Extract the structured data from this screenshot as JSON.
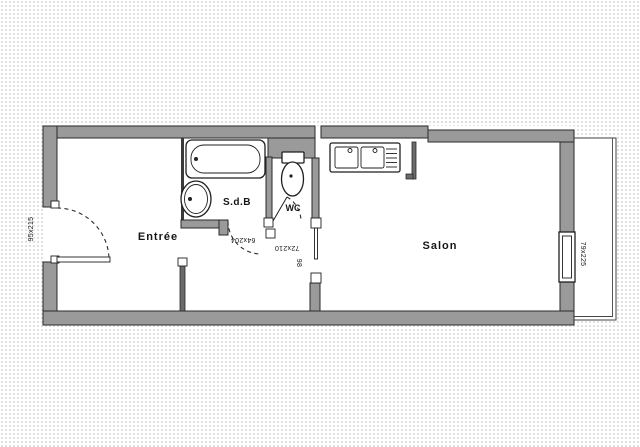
{
  "colors": {
    "paper": "#ffffff",
    "dot_grid": "#d7d7d7",
    "wall_fill": "#9a9a9a",
    "wall_dark": "#6b6b6b",
    "outline": "#2a2a2a"
  },
  "rooms": [
    {
      "name": "entree",
      "label": "Entrée"
    },
    {
      "name": "sdb",
      "label": "S.d.B"
    },
    {
      "name": "wc",
      "label": "WC"
    },
    {
      "name": "salon",
      "label": "Salon"
    }
  ],
  "dimension_labels": [
    {
      "name": "entrance-door",
      "label": "95x215"
    },
    {
      "name": "sdb-door",
      "label": "64x204"
    },
    {
      "name": "wc-door",
      "label": "72x210"
    },
    {
      "name": "hall-salon-door",
      "label": "98"
    },
    {
      "name": "salon-window",
      "label": "79x225"
    }
  ],
  "fixtures": [
    "bathtub",
    "washbasin",
    "toilet",
    "kitchen-double-sink",
    "window",
    "balcony"
  ]
}
